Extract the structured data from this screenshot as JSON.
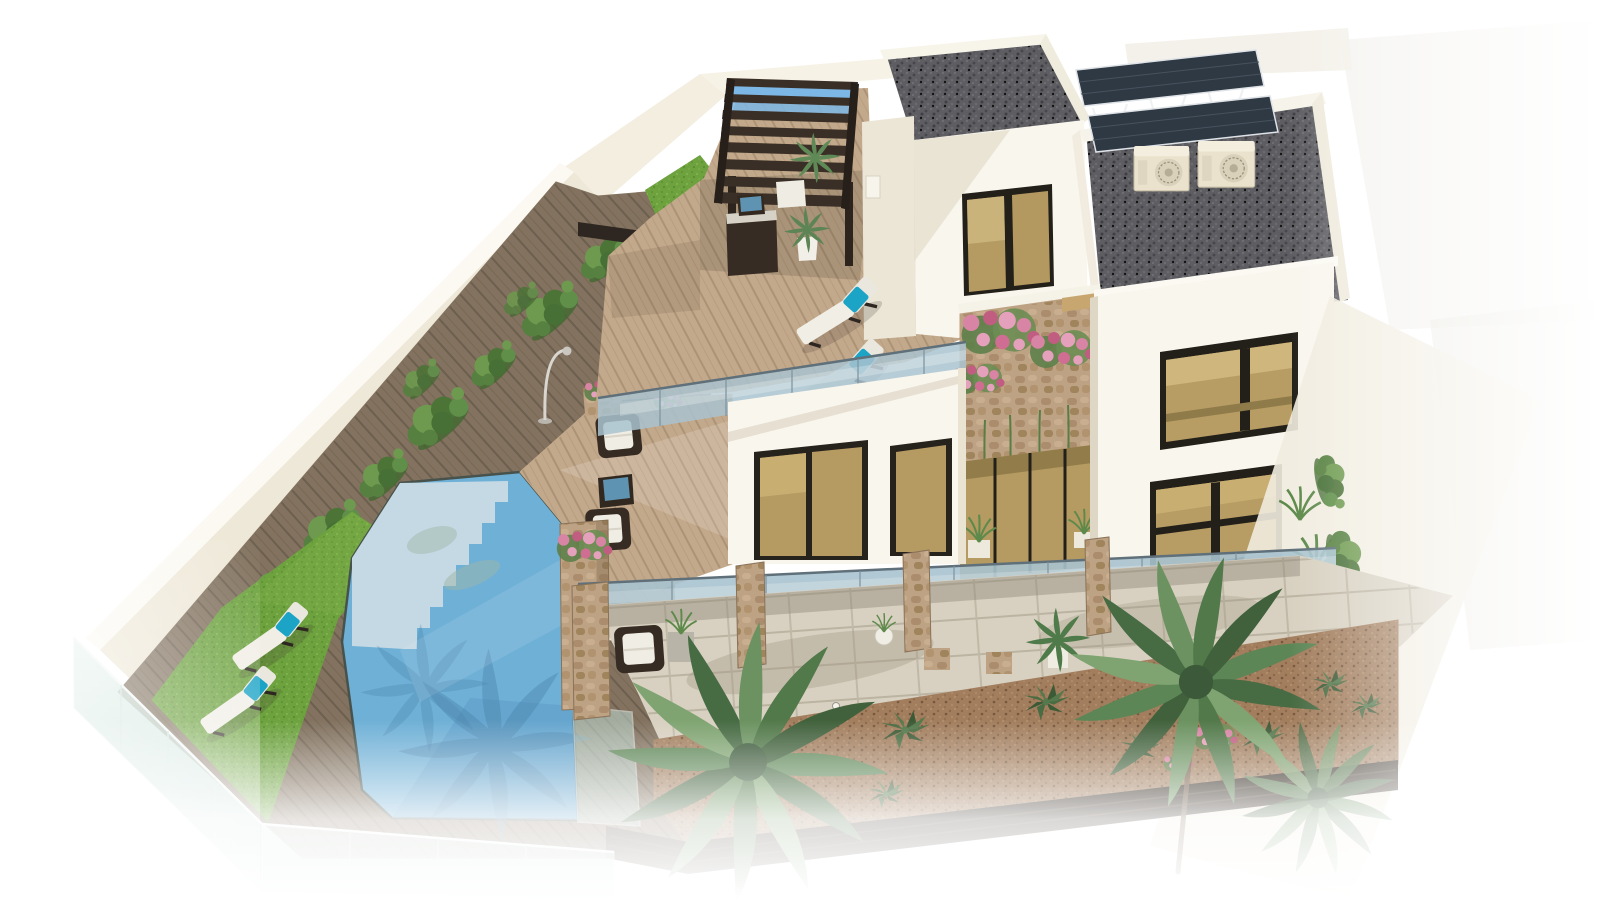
{
  "scene": {
    "type": "3d-architectural-render",
    "view": "aerial isometric",
    "subject": "modern two-storey villa with pool, deck terraces and landscaped garden",
    "background": "white studio fade",
    "objects": [
      "boundary-wall-with-ivy",
      "wood-pergola",
      "outdoor-kitchen",
      "roof-terrace-deck",
      "sun-loungers-teal-pillows",
      "glass-balustrade",
      "white-villa-volumes",
      "gravel-flat-roof",
      "ac-units",
      "solar-panel-pergola",
      "tan-glass-windows",
      "stone-clad-wall-bougainvillea",
      "swimming-pool-with-steps",
      "pool-glass-corner",
      "sunlit-wood-deck",
      "wicker-lounge-set",
      "blue-glass-table",
      "lawn-with-loungers",
      "glass-perimeter-fence",
      "stone-columns",
      "tiled-patio",
      "gravel-planting-bed",
      "agave-plants",
      "palm-trees",
      "pink-flower-clumps",
      "garden-lamp-post",
      "dark-garden-fence",
      "bollard-lights"
    ]
  },
  "colors": {
    "background": "#ffffff",
    "wall_cream": "#f4efe1",
    "wall_shadow": "#e3dbc8",
    "lawn_green": "#6da23f",
    "ivy_green": "#6d9a4e",
    "deck_shaded": "#82725f",
    "deck_sunlit": "#c3a98b",
    "pool_water": "#6fb0d6",
    "pool_steps": "#c4d9e4",
    "pool_reflection": "#4a83ab",
    "glass_balustrade": "#a9c3cf",
    "glass_fence": "#bfdcd4",
    "building_white": "#f9f6ee",
    "building_shade": "#e9e3d3",
    "gravel_roof": "#5d5d62",
    "window_frame": "#23201a",
    "window_glass": "#b59a62",
    "pergola_wood": "#3a2f26",
    "solar_panel": "#2e3944",
    "ac_cream": "#eae2cc",
    "stone_clad": "#bda283",
    "flower_pink": "#d884a4",
    "patio_tile": "#d8d1c1",
    "gravel_bed": "#a27e5e",
    "agave_green": "#4a6c42",
    "palm_green": "#5d8656",
    "towel_teal": "#1ca4c6",
    "cushion_white": "#f1eee6",
    "wicker_brown": "#372c23",
    "fence_dark": "#332a21",
    "table_glass_blue": "#5f93b2",
    "sky_gap_blue": "#7cb7e5"
  }
}
